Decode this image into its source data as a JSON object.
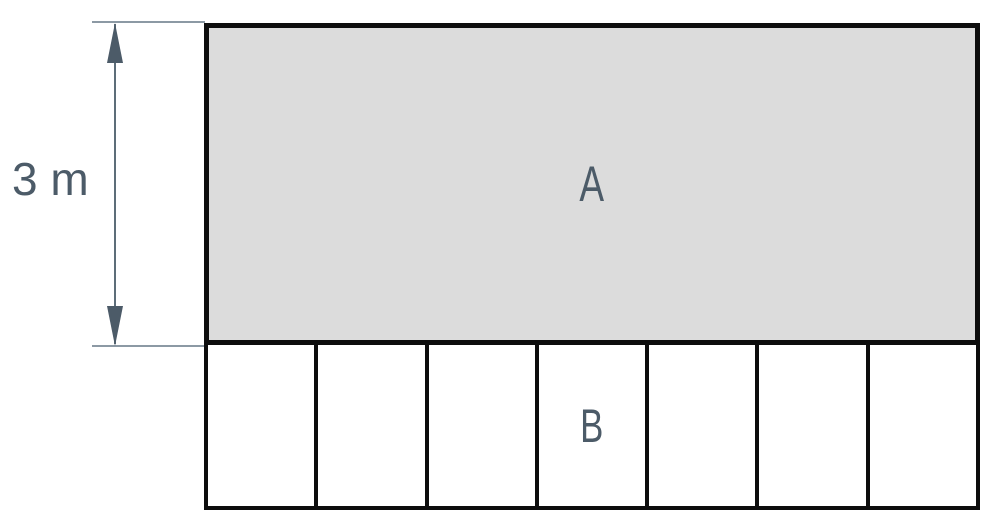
{
  "diagram": {
    "type": "geometry-figure",
    "dimension": {
      "label": "3 m",
      "measures": "height of region A",
      "arrow_direction": "vertical, double-headed"
    },
    "region_a": {
      "label": "A",
      "shape": "large shaded rectangle",
      "fill": "#dcdcdc"
    },
    "region_b": {
      "label": "B",
      "shape": "row of equal rectangular cells below region A",
      "cell_count": 7,
      "label_cell_index": 4,
      "fill": "#ffffff"
    },
    "colors": {
      "border": "#0d0d0d",
      "label_text": "#4c5b68",
      "dimension_line": "#5d6d79",
      "extension_line": "#8c99a4",
      "background": "#ffffff"
    }
  }
}
